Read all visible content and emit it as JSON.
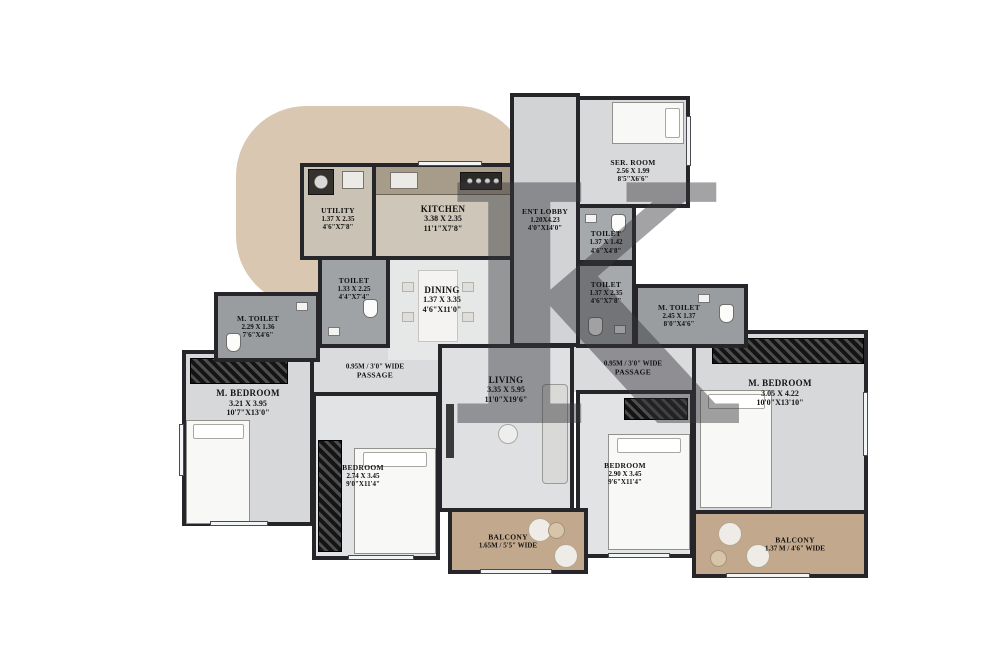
{
  "plan": {
    "watermark_letter": "K",
    "colors": {
      "wall": "#26262a",
      "brand_blob": "#d9c7b1",
      "balcony_floor": "#c2a98d",
      "toilet_floor": "#9fa3a6",
      "room_floor": "#d6d8da",
      "watermark": "#35353a"
    },
    "fixtures": [
      "bed",
      "wardrobe",
      "sofa",
      "tv-unit",
      "coffee-table",
      "dining-table",
      "dining-chair",
      "washing-machine",
      "kitchen-counter",
      "sink",
      "hob",
      "wc",
      "basin",
      "balcony-chair",
      "balcony-table",
      "window"
    ]
  },
  "rooms": {
    "utility": {
      "name": "UTILITY",
      "m": "1.37 X 2.35",
      "ft": "4'6\"X7'8\""
    },
    "kitchen": {
      "name": "KITCHEN",
      "m": "3.38 X 2.35",
      "ft": "11'1\"X7'8\""
    },
    "ent_lobby": {
      "name": "ENT LOBBY",
      "m": "1.20X4.23",
      "ft": "4'0\"X14'0\""
    },
    "ser_room": {
      "name": "SER. ROOM",
      "m": "2.56 X 1.99",
      "ft": "8'5\"X6'6\""
    },
    "toilet_a": {
      "name": "TOILET",
      "m": "1.37 X 1.42",
      "ft": "4'6\"X4'8\""
    },
    "toilet_b": {
      "name": "TOILET",
      "m": "1.37 X 2.35",
      "ft": "4'6\"X7'8\""
    },
    "toilet_c": {
      "name": "TOILET",
      "m": "1.33 X 2.25",
      "ft": "4'4\"X7'4\""
    },
    "m_toilet_left": {
      "name": "M. TOILET",
      "m": "2.29 X 1.36",
      "ft": "7'6\"X4'6\""
    },
    "m_toilet_right": {
      "name": "M. TOILET",
      "m": "2.45 X 1.37",
      "ft": "8'0\"X4'6\""
    },
    "dining": {
      "name": "DINING",
      "m": "1.37 X 3.35",
      "ft": "4'6\"X11'0\""
    },
    "living": {
      "name": "LIVING",
      "m": "3.35 X 5.95",
      "ft": "11'0\"X19'6\""
    },
    "m_bedroom_left": {
      "name": "M. BEDROOM",
      "m": "3.21 X 3.95",
      "ft": "10'7\"X13'0\""
    },
    "bedroom_left": {
      "name": "BEDROOM",
      "m": "2.74 X 3.45",
      "ft": "9'0\"X11'4\""
    },
    "bedroom_right": {
      "name": "BEDROOM",
      "m": "2.90 X 3.45",
      "ft": "9'6\"X11'4\""
    },
    "m_bedroom_right": {
      "name": "M. BEDROOM",
      "m": "3.05 X 4.22",
      "ft": "10'0\"X13'10\""
    },
    "passage_left": {
      "line1": "0.95M / 3'0\" WIDE",
      "line2": "PASSAGE"
    },
    "passage_right": {
      "line1": "0.95M / 3'0\" WIDE",
      "line2": "PASSAGE"
    },
    "balcony_center": {
      "line1": "BALCONY",
      "line2": "1.65M / 5'5\" WIDE"
    },
    "balcony_right": {
      "line1": "BALCONY",
      "line2": "1.37 M / 4'6\" WIDE"
    }
  }
}
